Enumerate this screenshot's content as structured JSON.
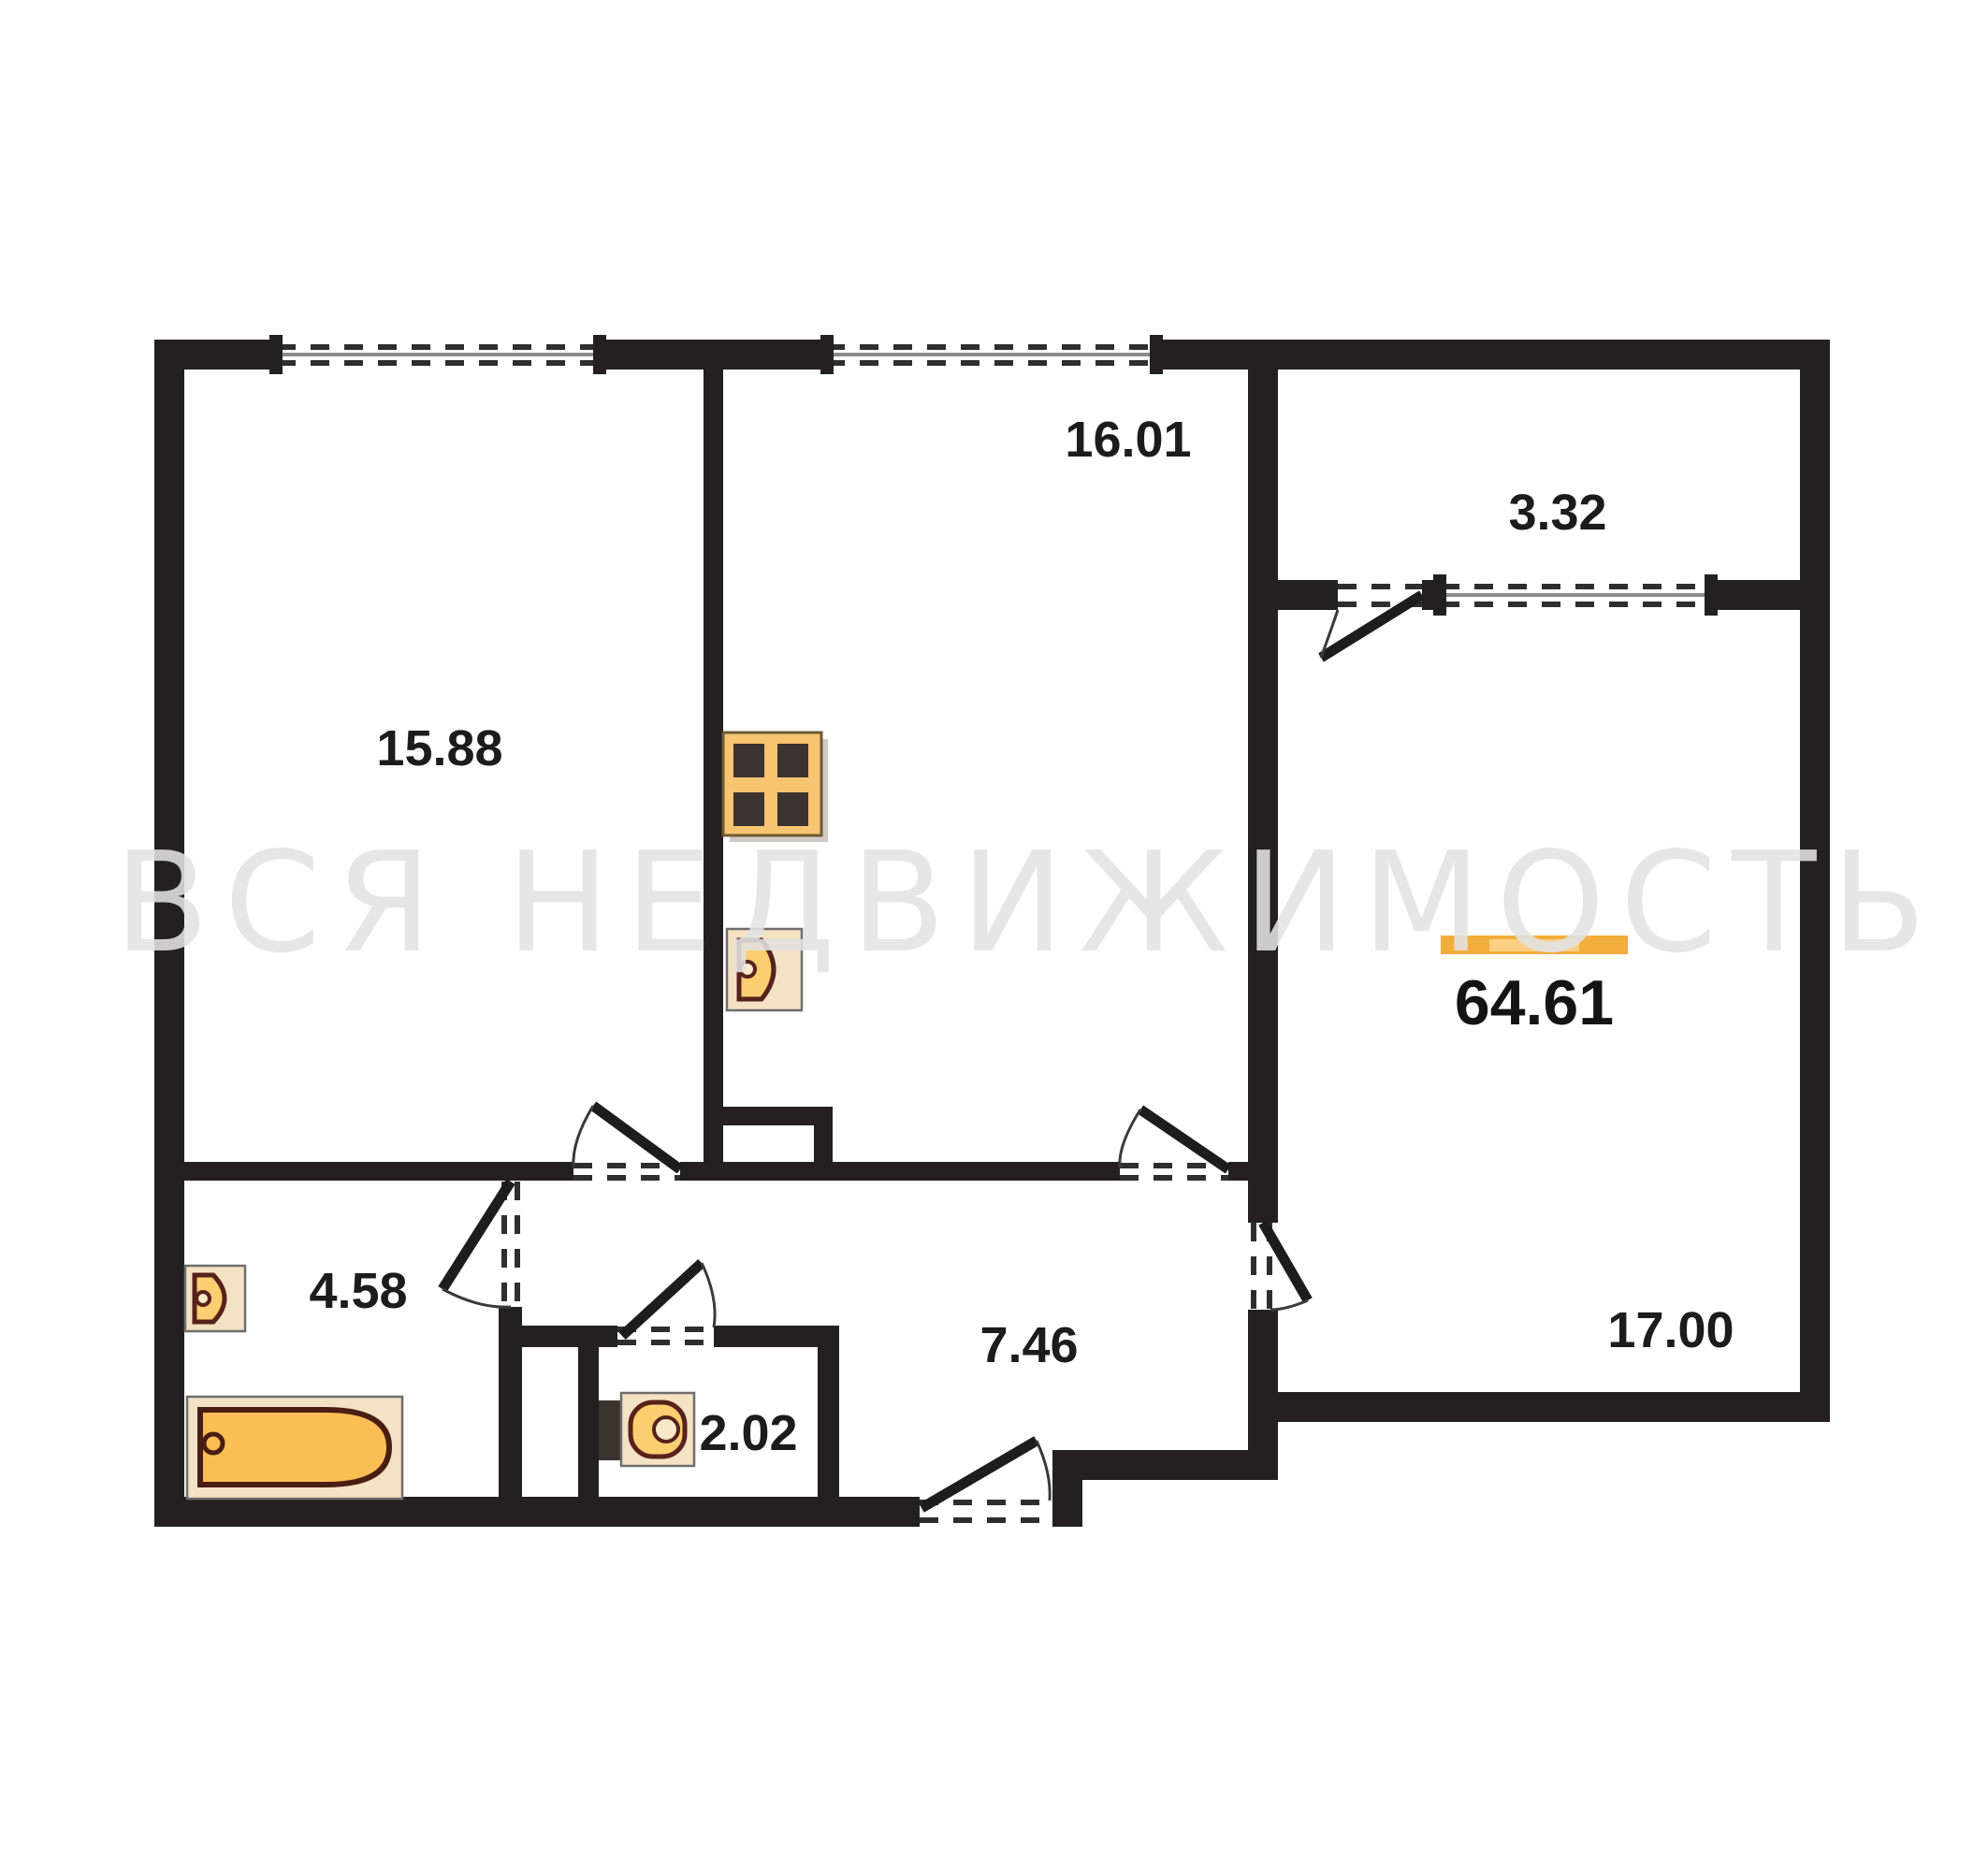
{
  "watermark_text": "ВСЯ НЕДВИЖИМОСТЬ",
  "total_area": "64.61",
  "rooms": {
    "living": "15.88",
    "kitchen": "16.01",
    "balcony": "3.32",
    "bathroom": "4.58",
    "wc": "2.02",
    "hallway": "7.46",
    "bedroom": "17.00"
  },
  "colors": {
    "wall": "#242021",
    "fixture_orange": "#FBBE55",
    "fixture_light": "#F3E2C3",
    "fixture_outline": "#57221B",
    "accent_bar": "#F2AE3C",
    "accent_bar_highlight": "#FBD083",
    "watermark": "#E3E3E3"
  },
  "icons": {
    "stove": "stove-icon",
    "kitchen_sink": "sink-icon",
    "washbasin": "washbasin-icon",
    "toilet": "toilet-icon",
    "bathtub": "bathtub-icon"
  }
}
